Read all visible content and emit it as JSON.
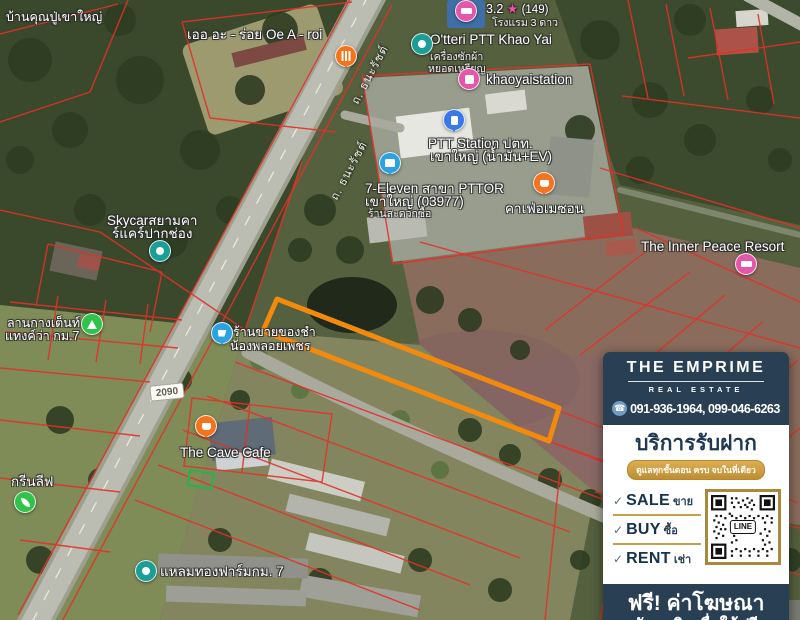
{
  "theme": {
    "navy": "#294054",
    "gold": "#cf9c3d",
    "parcel_line_red": "#e23128",
    "highlight_orange": "#f28a0d"
  },
  "map": {
    "road_labels": {
      "thanarat_1": "ถ. ธนะรัชต์",
      "thanarat_2": "ถ. ธนะรัชต์",
      "route_badge": "2090"
    },
    "pois": {
      "grandpa_house": {
        "label": "บ้านคุณปู่เขาใหญ่"
      },
      "hotel_rating": {
        "rating": "3.2",
        "star": "★",
        "reviews": "(149)",
        "subtitle": "โรงแรม 3 ดาว"
      },
      "oe_a_roi": {
        "label": "เออ อะ - ร่อย Oe A - roi"
      },
      "otteri": {
        "label": "O'tteri PTT Khao Yai",
        "sub1": "เครื่องซักผ้า",
        "sub2": "หยอดเหรียญ"
      },
      "khaoyaistation": {
        "label": "khaoyaistation"
      },
      "ptt_station": {
        "line1": "PTT Station ปตท.",
        "line2": "เขาใหญ่ (น้ำมัน+EV)"
      },
      "seven_eleven": {
        "line1": "7-Eleven สาขา PTTOR",
        "line2": "เขาใหญ่ (03977)",
        "line3": "ร้านสะดวกซื้อ"
      },
      "cafe_amazon": {
        "label": "คาเฟ่อเมซอน"
      },
      "inner_peace": {
        "label": "The Inner Peace Resort"
      },
      "skycar": {
        "line1": "Skycarสยามคา",
        "line2": "ร์แคร์ปากช่อง"
      },
      "tent_camp": {
        "line1": "ลานกางเต็นท์",
        "line2": "แทงค์ว่า กม.7"
      },
      "grocery": {
        "line1": "ร้านขายของชำ",
        "line2": "น้องพลอยเพชร"
      },
      "cave_cafe": {
        "label": "The Cave Cafe"
      },
      "green_leaf": {
        "label": "กรีนลีฟ"
      },
      "laemthong_farm": {
        "label": "แหลมทองฟาร์มกม. 7"
      }
    }
  },
  "ad_panel": {
    "brand": {
      "name": "THE EMPRIME",
      "subtitle": "REAL ESTATE"
    },
    "phone": "091-936-1964, 099-046-6263",
    "service_title": "บริการรับฝาก",
    "service_tagline": "ดูแลทุกขั้นตอน ครบ จบในที่เดียว",
    "check_mark": "✓",
    "checklist": [
      {
        "en": "SALE",
        "th": "ขาย"
      },
      {
        "en": "BUY",
        "th": "ซื้อ"
      },
      {
        "en": "RENT",
        "th": "เช่า"
      }
    ],
    "qr_label": "LINE",
    "footer_line1": "ฟรี! ค่าโฆษณา",
    "footer_line2": "จัดหาสินเชื่อให้ฟรี"
  }
}
